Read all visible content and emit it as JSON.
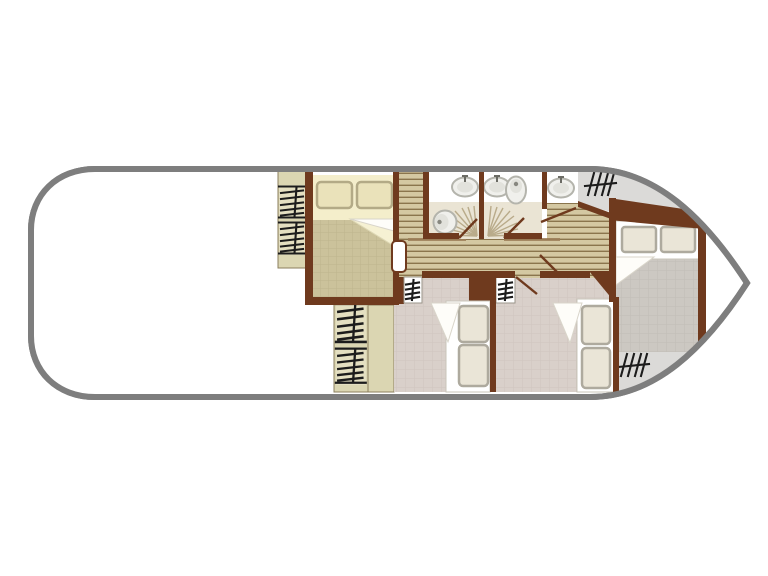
{
  "page": {
    "background": "#ffffff",
    "figure_type": "boat-floor-plan",
    "visible_text": []
  },
  "palette": {
    "hull_outline": "#7e7e7e",
    "deck_white": "#ffffff",
    "wall_brown": "#6f3a1e",
    "wood_floor": "#d4c8a2",
    "wood_line": "#8a754d",
    "khaki_panel": "#dbd6b2",
    "khaki_box": "#e4dfc1",
    "tan_blanket": "#cbc29b",
    "tan_grid": "#beb48c",
    "cream_sheet": "#f4eecb",
    "cream_pillow": "#eae2ba",
    "pillow_edge": "#b3aa86",
    "bath_white": "#ffffff",
    "bath_tile": "#eae4d4",
    "fixture_fill": "#f0f0ec",
    "fixture_edge": "#b4b4ac",
    "fixture_dot": "#87877f",
    "mauve_tile": "#d9d0ca",
    "mauve_grid": "#cec5bf",
    "gray_tile": "#ccc8c2",
    "gray_grid": "#c1bdb6",
    "gray_deck": "#dbdad8",
    "bed_white": "#ffffff",
    "bed_pillow": "#eae5d7",
    "bed_pillow_edge": "#aeaa9e",
    "fold_white": "#fefdf9",
    "fold_cream": "#f6f1d3",
    "spray": "#b9ab8a",
    "symbol_ink": "#1c1c1c"
  },
  "plan": {
    "hull": {
      "stern": "rounded-left",
      "bow": "pointed-right"
    },
    "rooms": [
      {
        "id": "aft-deck",
        "floor": "white-open-deck"
      },
      {
        "id": "double-bed-cabin",
        "floor": "tan-grid",
        "furniture": [
          "double-bed",
          "two-pillows",
          "folded-blanket"
        ]
      },
      {
        "id": "entry-passage",
        "floor": "wood-planks"
      },
      {
        "id": "corridor",
        "floor": "wood-planks"
      },
      {
        "id": "bathroom-left",
        "fixtures": [
          "washbasin",
          "toilet",
          "shower-spray",
          "door"
        ]
      },
      {
        "id": "bathroom-right",
        "fixtures": [
          "washbasin",
          "toilet",
          "shower-spray",
          "door"
        ]
      },
      {
        "id": "washbasin-alcove",
        "fixtures": [
          "washbasin",
          "door"
        ]
      },
      {
        "id": "stairway",
        "floor": "wood-steps"
      },
      {
        "id": "bow-cabin",
        "floor": "gray-grid",
        "furniture": [
          "double-bed",
          "two-pillows",
          "folded-blanket"
        ]
      },
      {
        "id": "lower-left-cabin",
        "floor": "mauve-grid",
        "furniture": [
          "bed",
          "two-pillows",
          "folded-blanket",
          "wardrobe",
          "locker"
        ]
      },
      {
        "id": "lower-right-cabin",
        "floor": "mauve-grid",
        "furniture": [
          "bed",
          "two-pillows",
          "folded-blanket",
          "wardrobe",
          "locker"
        ]
      }
    ],
    "step_symbols": [
      {
        "id": "steps-top-aft-upper"
      },
      {
        "id": "steps-top-aft-lower"
      },
      {
        "id": "steps-bottom-mid-upper"
      },
      {
        "id": "steps-bottom-mid-lower"
      },
      {
        "id": "locker-lower-left-cabin"
      },
      {
        "id": "locker-lower-right-cabin"
      },
      {
        "id": "steps-bow-top"
      },
      {
        "id": "steps-bow-bottom"
      }
    ]
  }
}
